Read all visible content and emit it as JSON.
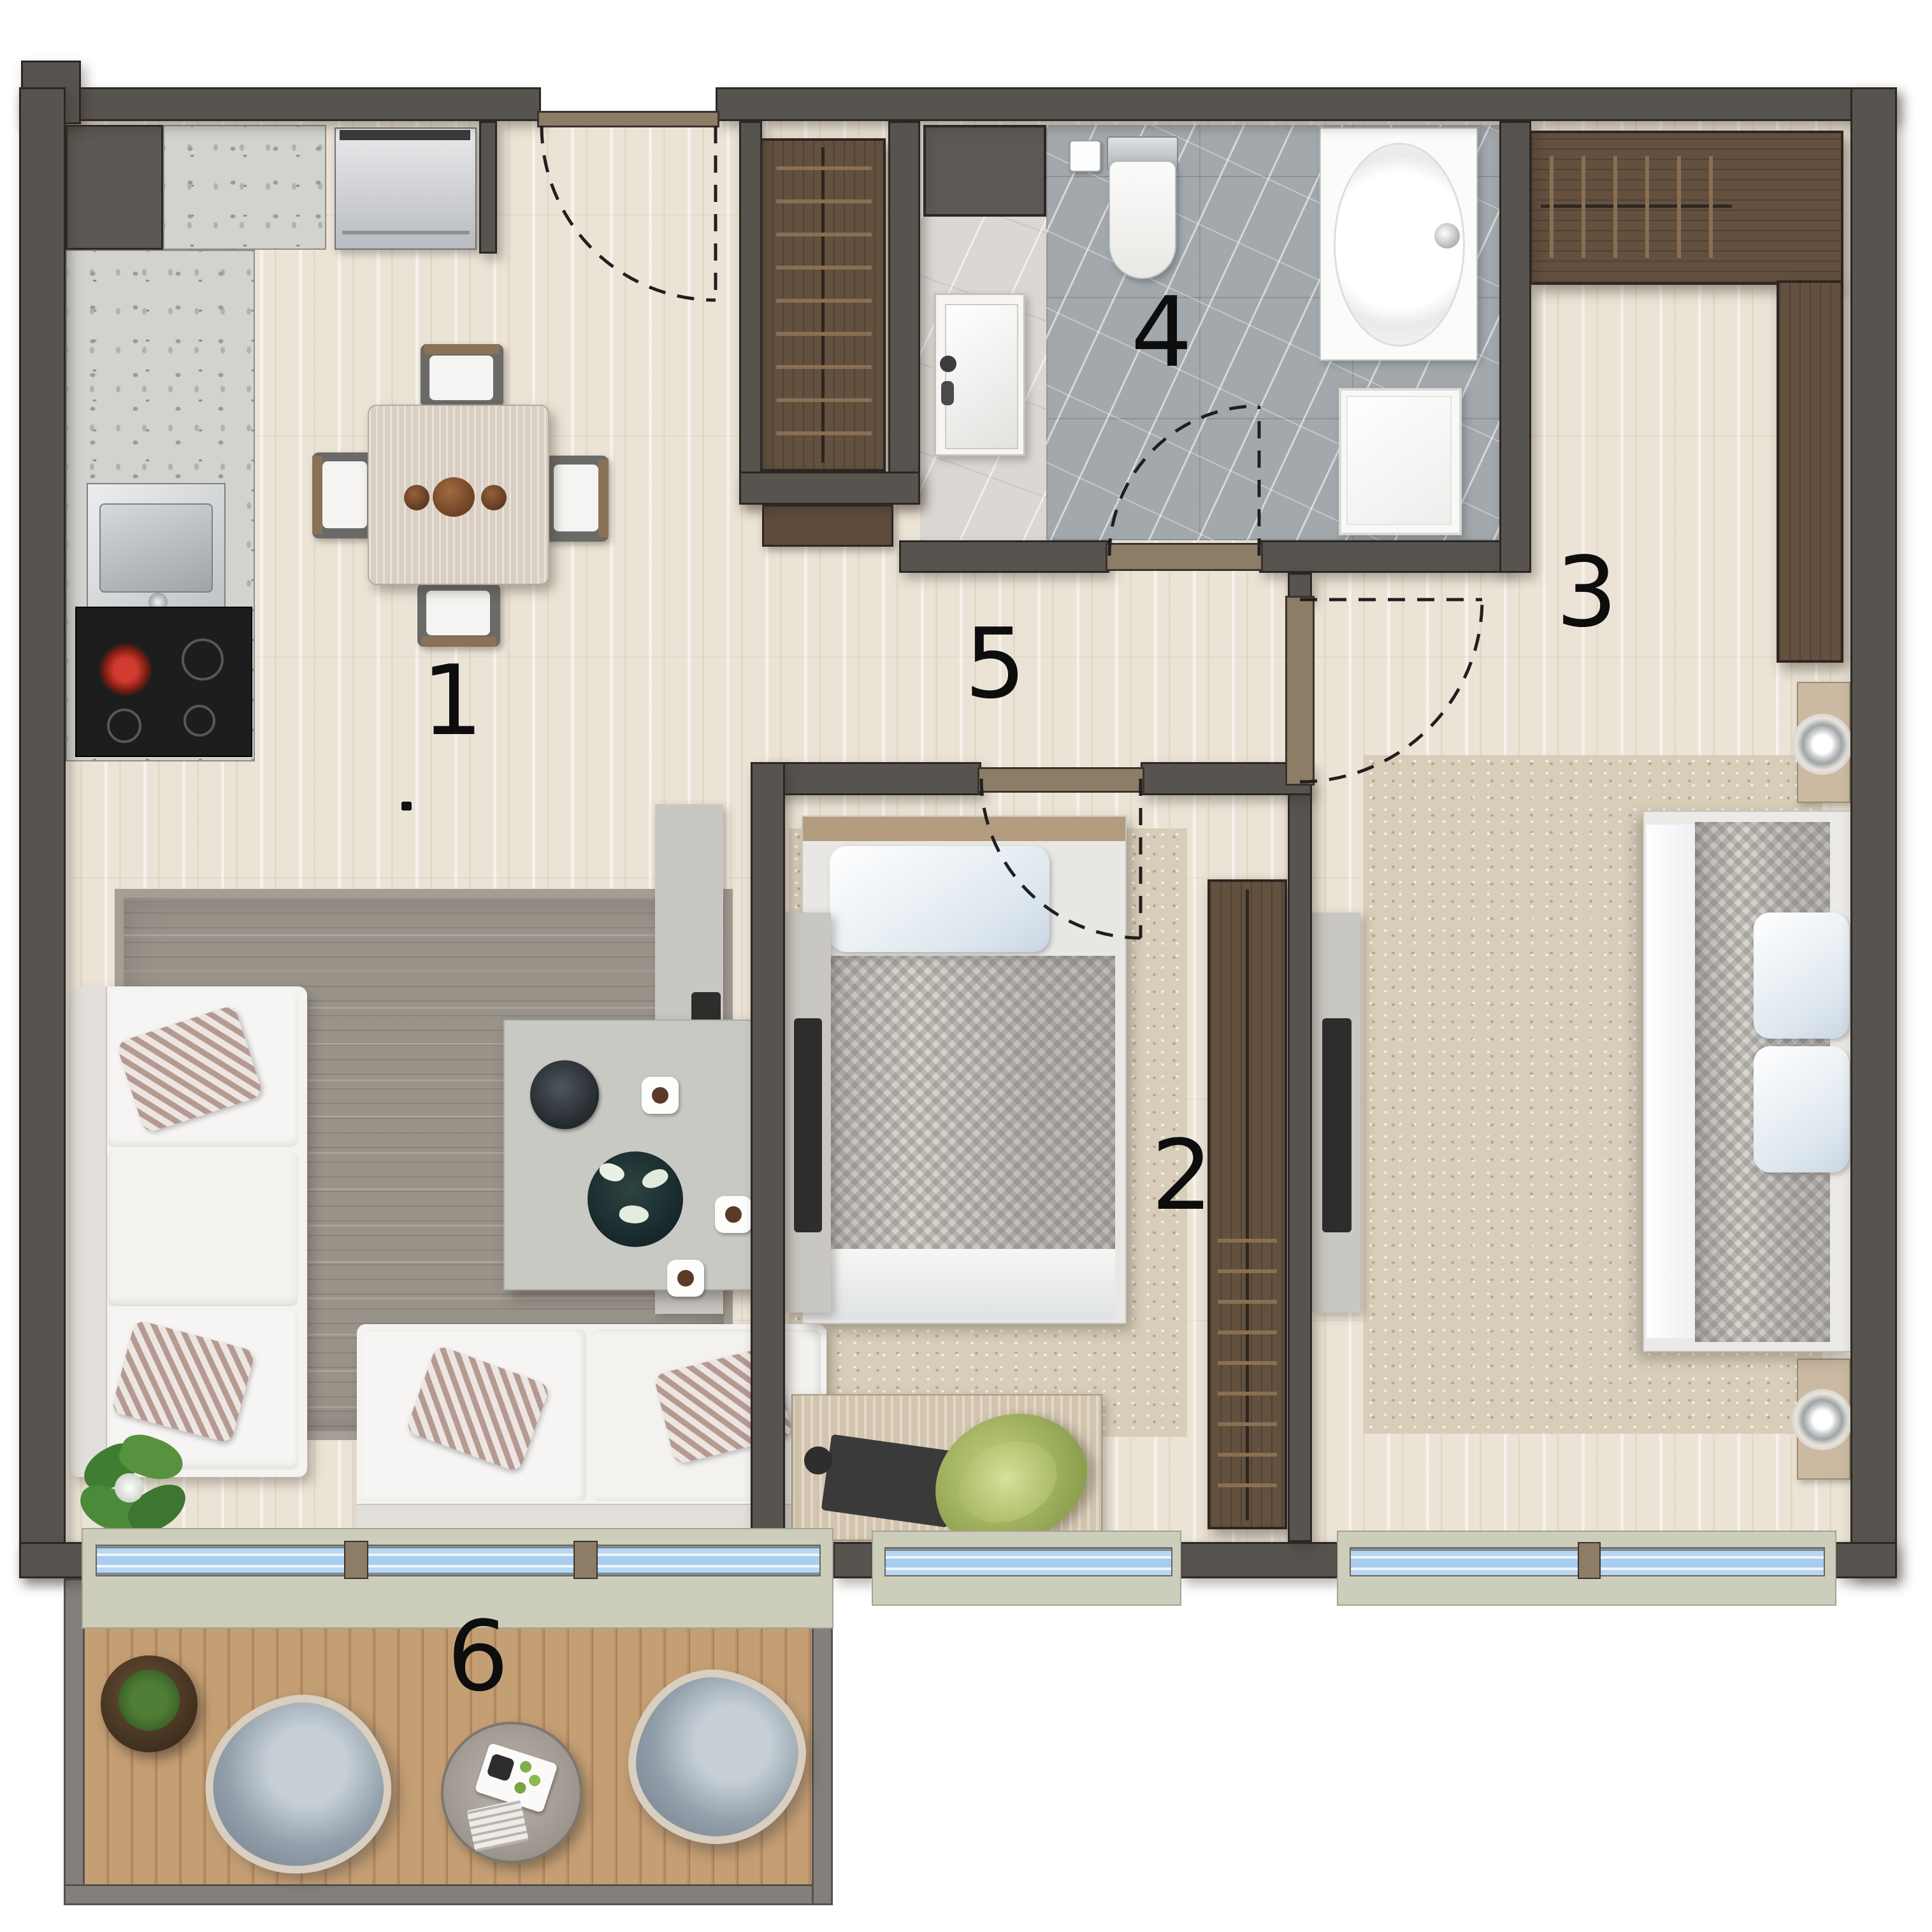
{
  "plan": {
    "type": "apartment-floor-plan",
    "rooms": [
      {
        "key": "living-dining-kitchen",
        "label": "1"
      },
      {
        "key": "bedroom",
        "label": "2"
      },
      {
        "key": "master-bedroom",
        "label": "3"
      },
      {
        "key": "bathroom",
        "label": "4"
      },
      {
        "key": "hallway",
        "label": "5"
      },
      {
        "key": "balcony",
        "label": "6"
      }
    ],
    "colors": {
      "wall": "#57534f",
      "wood_floor": "#ebe3d6",
      "balcony_deck": "#c59f74",
      "bathroom_marble": "#a3a8ad",
      "alcove_marble": "#dbd7d2",
      "window_glass": "#a9cdee",
      "window_sill": "#cdcdbc",
      "threshold": "#8d7d67",
      "dark_wood": "#63503f",
      "rug_gray": "#99938a",
      "rug_beige": "#d8cdb9",
      "chair_green": "#a3b661"
    },
    "fixtures": [
      "duct-shaft",
      "fridge",
      "kitchen-counter",
      "kitchen-sink",
      "cooktop",
      "dining-table",
      "dining-chair",
      "sofa",
      "coffee-table",
      "area-rug",
      "tv-panel",
      "plant",
      "entry-closet",
      "console-shelf",
      "vanity-sink",
      "toilet",
      "paper-holder",
      "shower-tray",
      "washing-machine",
      "single-bed",
      "desk",
      "desk-chair",
      "wardrobe",
      "corner-wardrobe",
      "double-bed",
      "nightstand",
      "table-lamp",
      "pouf-chair",
      "outdoor-table",
      "planter",
      "window",
      "door-swing"
    ]
  }
}
